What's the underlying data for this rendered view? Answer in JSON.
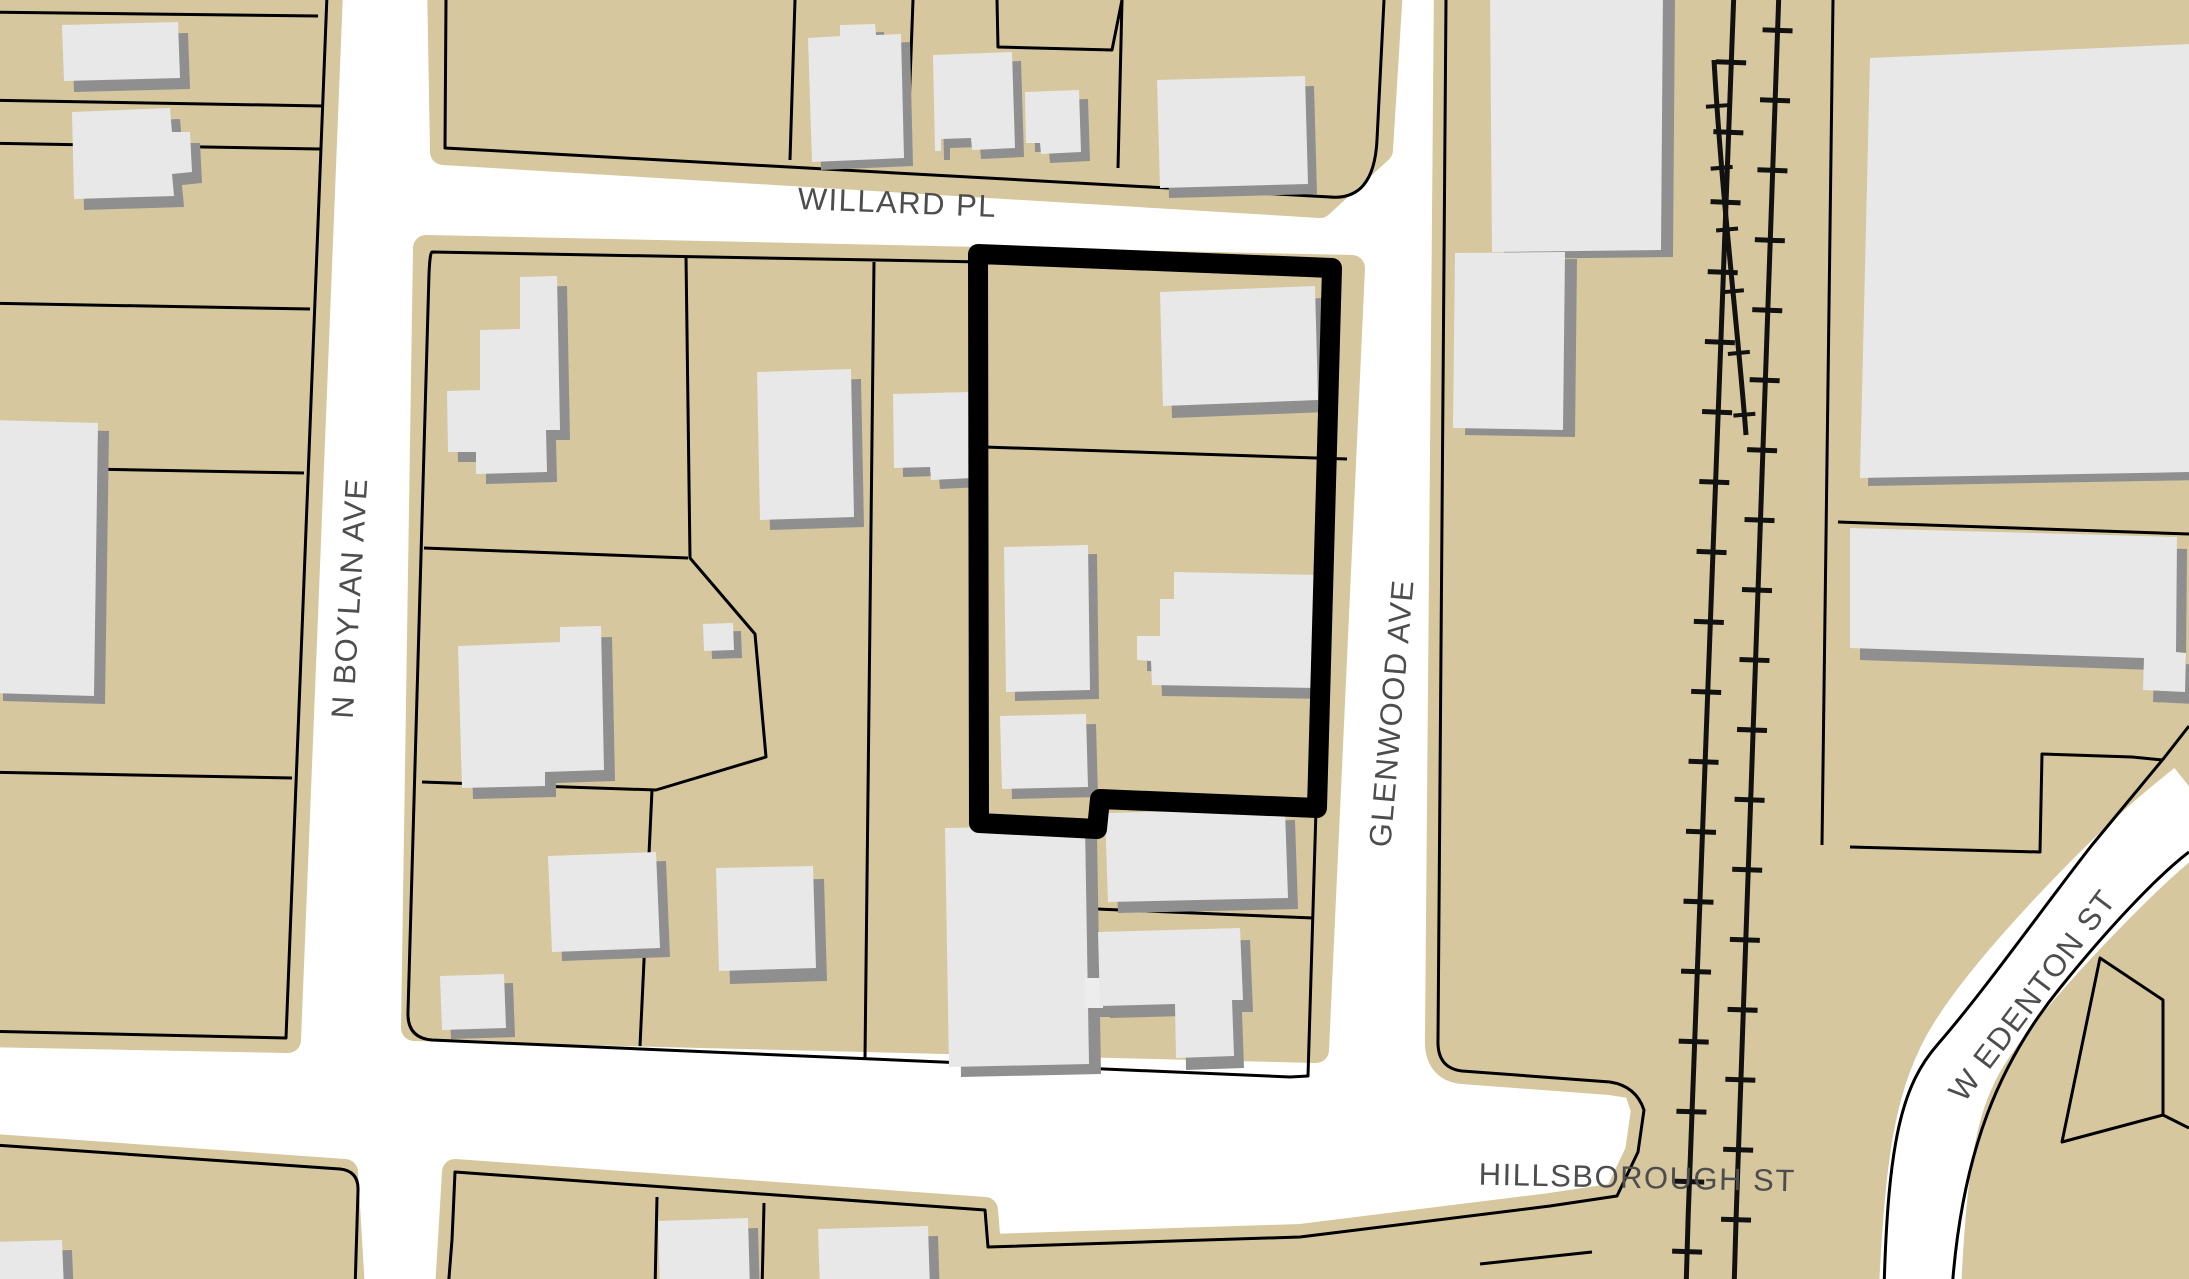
{
  "map": {
    "streets": {
      "willard": {
        "label": "WILLARD PL"
      },
      "boylan": {
        "label": "N BOYLAN AVE"
      },
      "glenwood": {
        "label": "GLENWOOD AVE"
      },
      "hillsborough": {
        "label": "HILLSBOROUGH ST"
      },
      "edenton": {
        "label": "W EDENTON ST"
      }
    },
    "highlighted_parcel": {
      "description": "Parcel outlined with thick black border on east side of block, fronting Glenwood Ave south of Willard Pl"
    },
    "colors": {
      "parcel_fill": "#d6c79e",
      "road": "#ffffff",
      "building": "#e8e8e8",
      "building_shadow": "#8f8f8f",
      "parcel_boundary": "#000000",
      "highlight_outline": "#000000",
      "railroad": "#111111",
      "street_label": "#4d4d4d"
    }
  }
}
